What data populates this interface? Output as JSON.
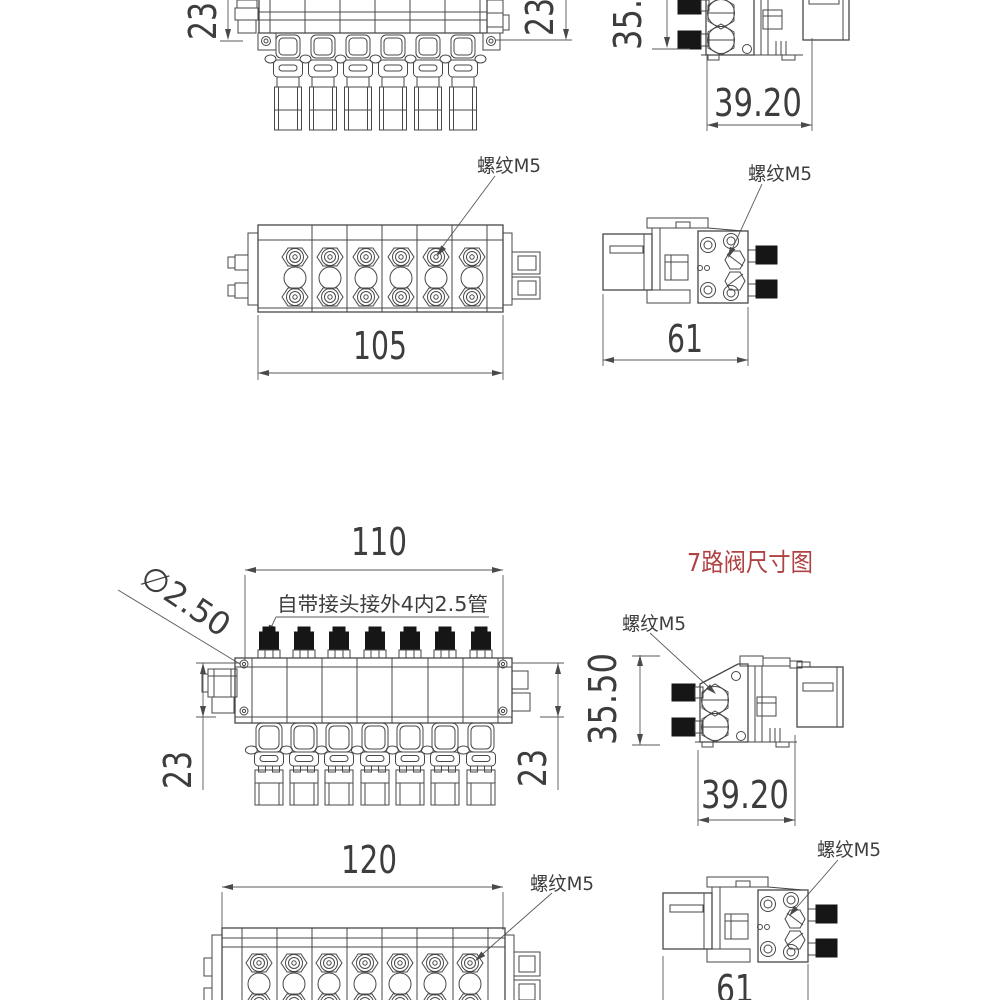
{
  "title": {
    "text": "7路阀尺寸图"
  },
  "labels": {
    "thread_m5": "螺纹M5",
    "fitting_note": "自带接头接外4内2.5管",
    "diameter_label": "∅2.50"
  },
  "dims": {
    "d23": "23",
    "d35_50": "35.50",
    "d39_20": "39.20",
    "d105": "105",
    "d110": "110",
    "d120": "120",
    "d61": "61"
  },
  "colors": {
    "line": "#474747",
    "text": "#3d3d3d",
    "accent_red": "#b04242",
    "fitting_black": "#161616",
    "background": "#ffffff"
  }
}
